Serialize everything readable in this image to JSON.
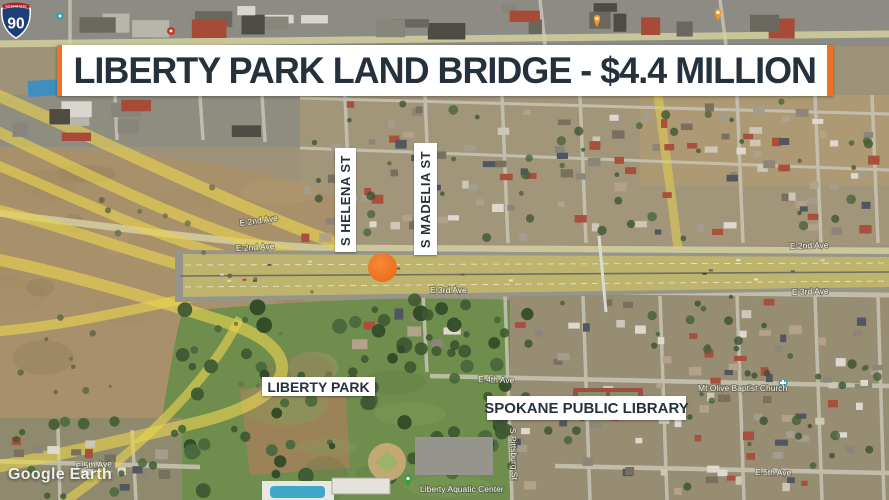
{
  "banner": {
    "title": "LIBERTY PARK LAND BRIDGE - $4.4 MILLION"
  },
  "signs": {
    "helena": "S HELENA ST",
    "madelia": "S MADELIA ST",
    "park": "LIBERTY PARK",
    "library": "SPOKANE PUBLIC LIBRARY"
  },
  "shield": {
    "top": "INTERSTATE",
    "number": "90"
  },
  "roads": {
    "e2nd_w1": "E 2nd Ave",
    "e2nd_w2": "E 2nd Ave",
    "e2nd_e": "E 2nd Ave",
    "e3rd_c": "E 3rd Ave",
    "e3rd_e": "E 3rd Ave",
    "e4th": "E 4th Ave",
    "e5th_w": "E 5th Ave",
    "e5th_e": "E 5th Ave",
    "pittsburg": "S Pittsburg St"
  },
  "pois": {
    "aquatic_center": "Liberty Aquatic Center",
    "church": "Mt Olive Baptist Church"
  },
  "watermark": "Google Earth",
  "colors": {
    "accent_orange": "#F07123",
    "marker_orange": "#EF7522",
    "title_navy": "#25323E"
  }
}
